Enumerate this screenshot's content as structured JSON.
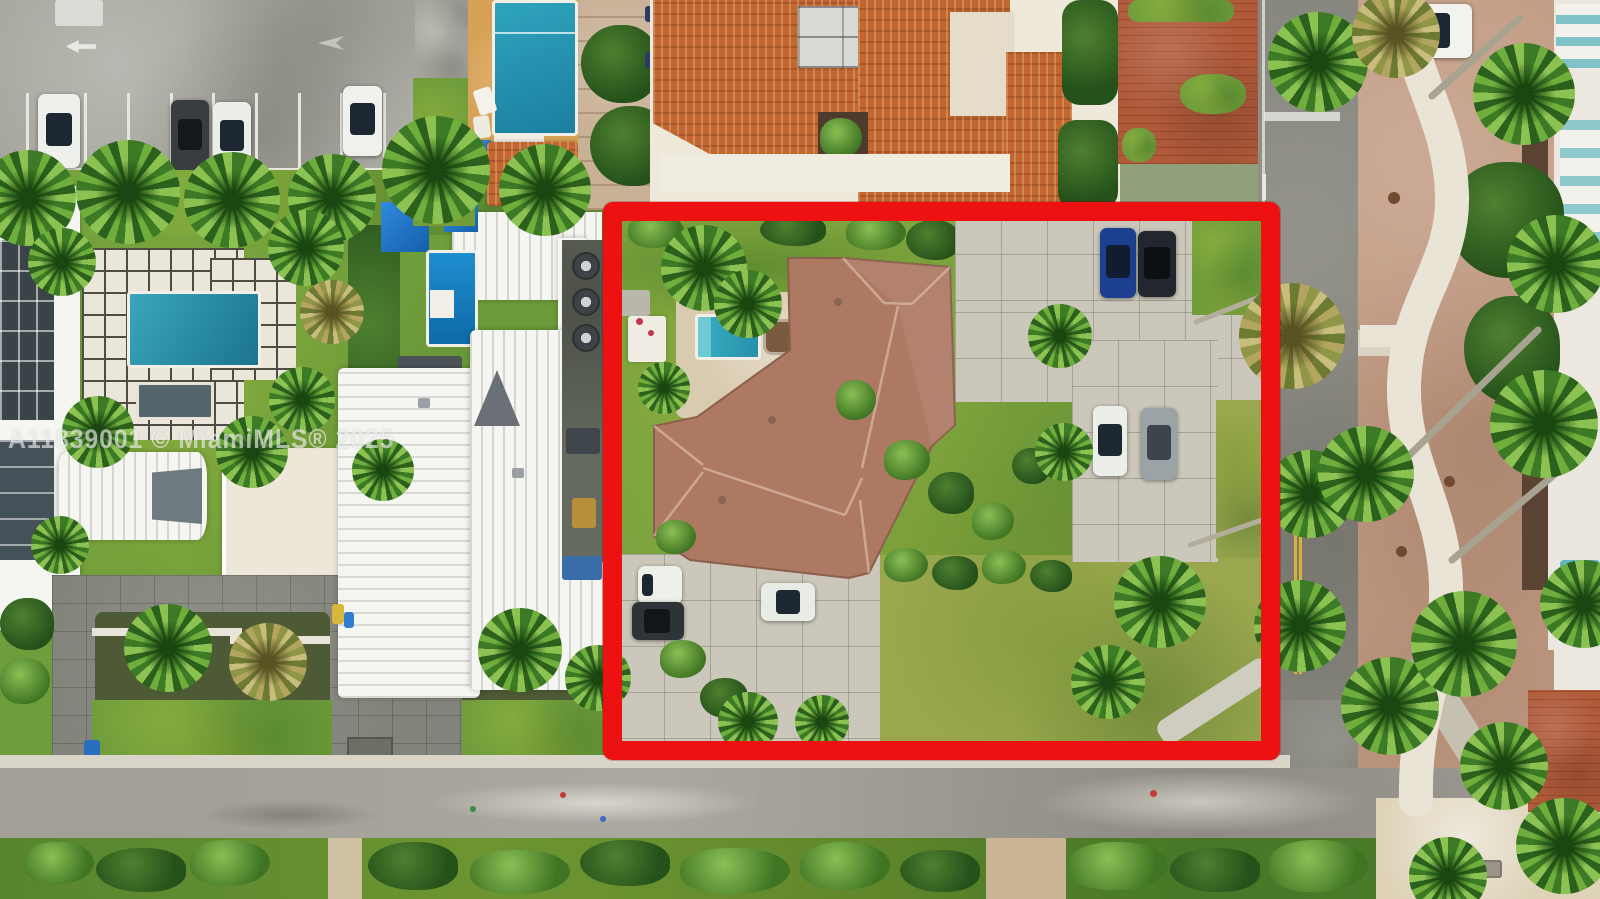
{
  "watermark": {
    "text": "A11839001 © MiamiMLS® 2025"
  },
  "palette": {
    "outline-red": "#ee1111",
    "pool-teal": "#35a8bd",
    "roof-terracotta": "#ad7963",
    "roof-orange": "#c2672f",
    "grass-green": "#6f9d3c",
    "asphalt-gray": "#9c9a92",
    "concrete-gray": "#cbc8bb",
    "promenade-tan": "#c29b83",
    "brick-red": "#b05a3a",
    "awning-teal": "#2a9c8d",
    "canopy-blue": "#1e7bd0"
  },
  "scene": {
    "type": "aerial drone photograph of a residential corner lot (real-estate listing)",
    "highlighted_property": {
      "outline": "thick red rectangle",
      "house": "single-story home with brown hip tile roof",
      "pool": "small rectangular pool, teal water, beige deck, teal awning",
      "parked_vehicles": [
        "blue sedan",
        "black SUV",
        "white sedan",
        "silver SUV",
        "white van",
        "dark SUV",
        "white hatchback"
      ],
      "grounds": "large yellow-green lawn, concrete driveways, palms and shrubs"
    },
    "surroundings": {
      "top_left": "gray parking lot with striped stalls and four parked cars",
      "left": "modern white buildings, gridded pool deck with teal pool and spa, barrel-vault roof",
      "center": "white flat-roof house with blue canopies and blue lap pool",
      "top": "Spanish-style building with orange barrel-tile roof, courtyard and large pool",
      "right": "street with double yellow line, palm-lined tan paver promenade, winding white sidewalk, small US flag",
      "bottom": "cross street, hedge verge, sandy beach patch with bench"
    }
  }
}
